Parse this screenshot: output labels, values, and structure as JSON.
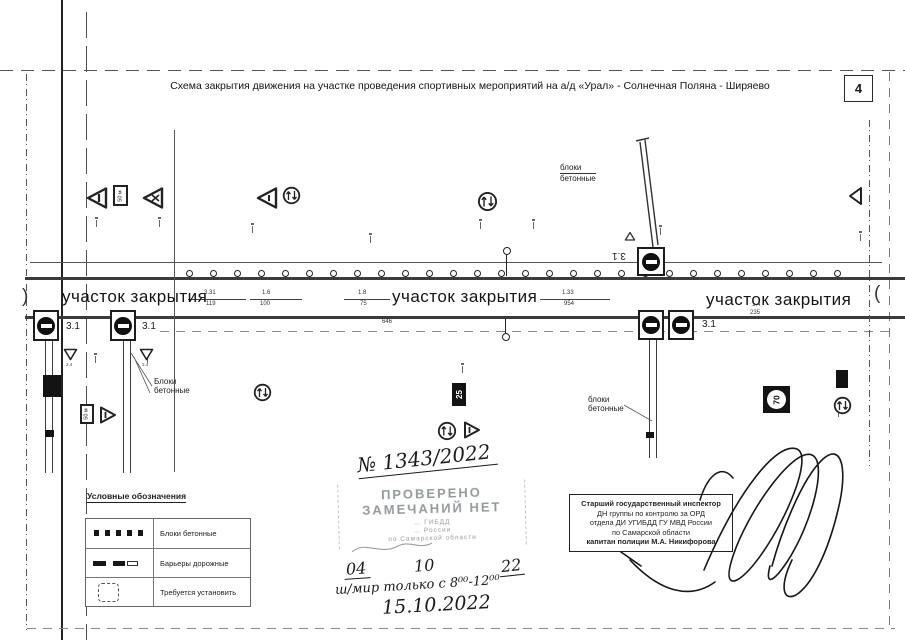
{
  "page": {
    "title": "Схема закрытия движения на участке проведения спортивных мероприятий на а/д  «Урал» - Солнечная Поляна - Ширяево",
    "number": "4"
  },
  "road": {
    "closure_label": "участок закрытия",
    "continuation_left": ")",
    "continuation_right": "(",
    "sign_3_1": "3.1",
    "sign_2_4": "2.4",
    "plaque_50m": "50 м",
    "km_25": "25",
    "km_70": "70",
    "blocks_count": 28,
    "blocks_top": {
      "l1": "блоки",
      "l2": "бетонные"
    },
    "blocks_left": {
      "l1": "Блоки",
      "l2": "бетонные"
    },
    "blocks_right": {
      "l1": "блоки",
      "l2": "бетонные"
    },
    "dims": {
      "a1": "3.31",
      "a2": "119",
      "b1": "1.6",
      "b2": "100",
      "c1": "1.8",
      "c2": "75",
      "d1": "1.33",
      "d2": "954",
      "e": "646",
      "f1": "1.4",
      "f2": "235"
    }
  },
  "legend": {
    "heading": "Условные обозначения",
    "items": [
      {
        "label": "Блоки бетонные"
      },
      {
        "label": "Барьеры дорожные"
      },
      {
        "label": "Требуется установить"
      }
    ]
  },
  "handwriting": {
    "doc_number": "№ 1343/2022",
    "date_day": "04",
    "date_month": "10",
    "date_year": "22",
    "note": "ш/мир только с 8⁰⁰-12⁰⁰",
    "date_full": "15.10.2022"
  },
  "stamp": {
    "line1": "ПРОВЕРЕНО",
    "line2": "ЗАМЕЧАНИЙ НЕТ",
    "sub1": "… ГИБДД",
    "sub2": "… России",
    "sub3": "по Самарской области"
  },
  "signature": {
    "lines": [
      "Старший государственный инспектор",
      "ДН группы по контролю за ОРД",
      "отдела ДИ УГИБДД ГУ МВД России",
      "по Самарской области",
      "капитан полиции М.А. Никифорова"
    ]
  }
}
